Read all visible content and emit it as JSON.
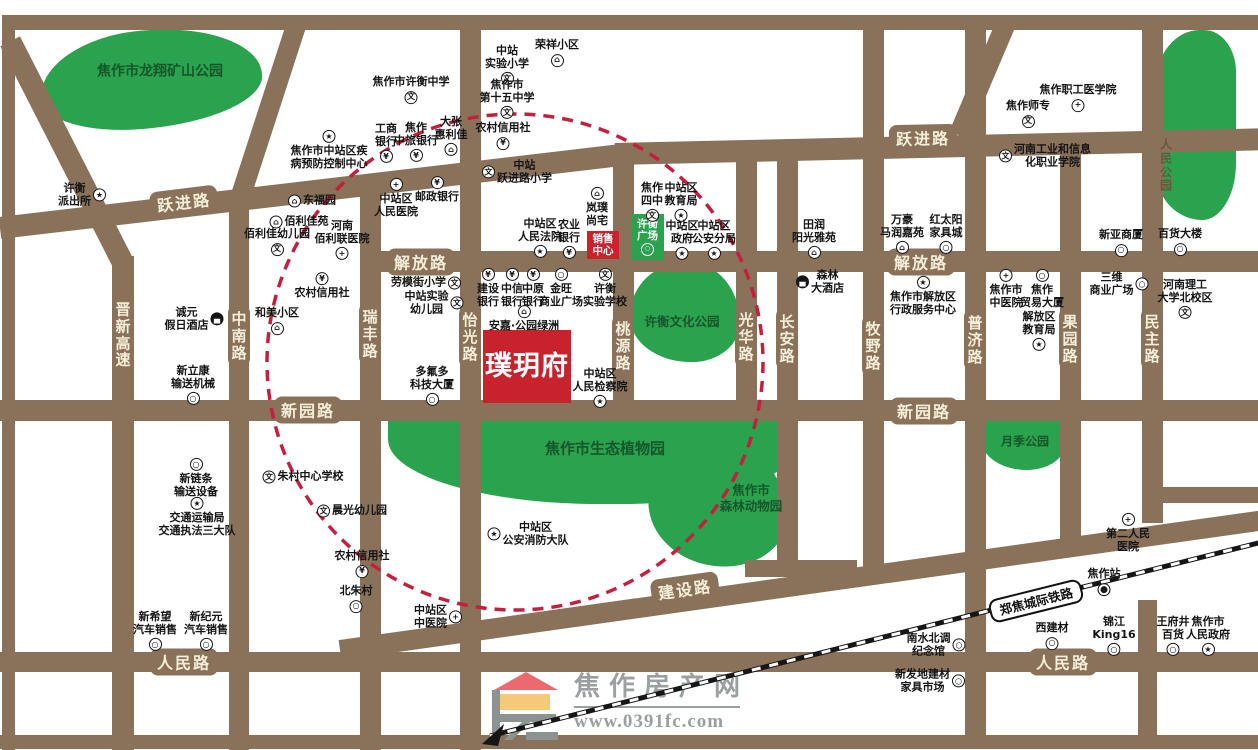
{
  "project": {
    "name": "璞玥府",
    "sales_label": "销售\n中心",
    "plaza_label": "许衡\n广场"
  },
  "logo": {
    "title": "焦作房产网",
    "url": "www.0391fc.com"
  },
  "colors": {
    "road": "#8a7159",
    "road_label_text": "#f6eed8",
    "park_green": "#2ba24d",
    "park_label": "#14572b",
    "accent_red": "#c8222d",
    "circle_red": "#c41f3e",
    "railway_black": "#161616",
    "logo_gray": "#9aa0a0",
    "logo_roof_red": "#ec6a6d",
    "logo_yellow": "#f6c87a"
  },
  "map": {
    "railway": {
      "label": "郑焦城际铁路",
      "station": "焦作站"
    },
    "road_labels_h": [
      {
        "t": "跃进路",
        "x": 184,
        "y": 202,
        "r": -7
      },
      {
        "t": "跃进路",
        "x": 923,
        "y": 138,
        "r": -1
      },
      {
        "t": "解放路",
        "x": 421,
        "y": 262,
        "r": 0
      },
      {
        "t": "解放路",
        "x": 921,
        "y": 262,
        "r": 0
      },
      {
        "t": "新园路",
        "x": 308,
        "y": 410,
        "r": 0
      },
      {
        "t": "新园路",
        "x": 924,
        "y": 411,
        "r": 0
      },
      {
        "t": "建设路",
        "x": 685,
        "y": 589,
        "r": -8
      },
      {
        "t": "人民路",
        "x": 184,
        "y": 662,
        "r": 0
      },
      {
        "t": "人民路",
        "x": 1063,
        "y": 662,
        "r": 0
      }
    ],
    "road_labels_v": [
      {
        "t": "晋新高速",
        "x": 123,
        "y": 335
      },
      {
        "t": "中南路",
        "x": 239,
        "y": 336
      },
      {
        "t": "瑞丰路",
        "x": 370,
        "y": 334
      },
      {
        "t": "怡光路",
        "x": 470,
        "y": 337
      },
      {
        "t": "桃源路",
        "x": 623,
        "y": 346
      },
      {
        "t": "光华路",
        "x": 746,
        "y": 337
      },
      {
        "t": "长安路",
        "x": 787,
        "y": 339
      },
      {
        "t": "牧野路",
        "x": 873,
        "y": 346
      },
      {
        "t": "普济路",
        "x": 975,
        "y": 340
      },
      {
        "t": "果园路",
        "x": 1070,
        "y": 339
      },
      {
        "t": "民主路",
        "x": 1152,
        "y": 339
      }
    ],
    "parks": [
      {
        "name": "焦作市龙翔矿山公园",
        "x": 40,
        "y": 30,
        "w": 222,
        "h": 98,
        "lx": 160,
        "ly": 72,
        "cls": "p1",
        "fs": 14,
        "style": "green",
        "vertical": false
      },
      {
        "name": "人民公园",
        "x": 1156,
        "y": 30,
        "w": 80,
        "h": 190,
        "lx": 1166,
        "ly": 166,
        "cls": "p2",
        "fs": 12,
        "style": "brown",
        "vertical": true
      },
      {
        "name": "许衡文化公园",
        "x": 630,
        "y": 262,
        "w": 110,
        "h": 100,
        "lx": 682,
        "ly": 322,
        "cls": "p3",
        "fs": 12.5,
        "style": "green",
        "vertical": false
      },
      {
        "name": "焦作市生态植物园",
        "x": 388,
        "y": 406,
        "w": 406,
        "h": 98,
        "lx": 605,
        "ly": 449,
        "cls": "p4",
        "fs": 15,
        "style": "green",
        "vertical": false
      },
      {
        "name": "焦作市\n森林动物园",
        "x": 648,
        "y": 448,
        "w": 140,
        "h": 118,
        "lx": 751,
        "ly": 498,
        "cls": "p5",
        "fs": 12.5,
        "style": "green",
        "vertical": false
      },
      {
        "name": "月季公园",
        "x": 981,
        "y": 416,
        "w": 84,
        "h": 54,
        "lx": 1025,
        "ly": 442,
        "cls": "p6",
        "fs": 12,
        "style": "green",
        "vertical": false
      }
    ],
    "pois": [
      {
        "n": "许衡\n派出所",
        "x": 82,
        "y": 195,
        "i": "gov",
        "p": "right"
      },
      {
        "n": "焦作市许衡中学",
        "x": 411,
        "y": 90,
        "i": "school",
        "p": "bottom"
      },
      {
        "n": "中站\n实验小学",
        "x": 507,
        "y": 65,
        "i": "school",
        "p": "bottom"
      },
      {
        "n": "荣祥小区",
        "x": 557,
        "y": 53,
        "i": "estate",
        "p": "bottom"
      },
      {
        "n": "焦作市\n第十五中学",
        "x": 507,
        "y": 99,
        "i": "school",
        "p": "bottom"
      },
      {
        "n": "农村信用社",
        "x": 503,
        "y": 136,
        "i": "bank",
        "p": "bottom"
      },
      {
        "n": "大张\n惠利佳",
        "x": 451,
        "y": 136,
        "i": "estate",
        "p": "bottom"
      },
      {
        "n": "工商\n银行",
        "x": 386,
        "y": 143,
        "i": "bank",
        "p": "bottom"
      },
      {
        "n": "焦作\n中旅银行",
        "x": 416,
        "y": 142,
        "i": "bank",
        "p": "bottom"
      },
      {
        "n": "焦作市中站区疾\n病预防控制中心",
        "x": 329,
        "y": 150,
        "i": "gov",
        "p": "top"
      },
      {
        "n": "东福园",
        "x": 312,
        "y": 201,
        "i": "estate",
        "p": "left"
      },
      {
        "n": "佰利佳苑",
        "x": 299,
        "y": 222,
        "i": "estate",
        "p": "left"
      },
      {
        "n": "佰利佳幼儿园",
        "x": 277,
        "y": 242,
        "i": "school",
        "p": "bottom"
      },
      {
        "n": "河南\n佰利联医院",
        "x": 342,
        "y": 240,
        "i": "hospital",
        "p": "bottom"
      },
      {
        "n": "中站区\n人民医院",
        "x": 396,
        "y": 198,
        "i": "hospital",
        "p": "top"
      },
      {
        "n": "邮政银行",
        "x": 437,
        "y": 190,
        "i": "bank",
        "p": "top"
      },
      {
        "n": "中站\n跃进路小学",
        "x": 517,
        "y": 172,
        "i": "school",
        "p": "left"
      },
      {
        "n": "岚璞\n尚宅",
        "x": 597,
        "y": 207,
        "i": "estate",
        "p": "top"
      },
      {
        "n": "中站区\n人民法院",
        "x": 540,
        "y": 238,
        "i": "gov",
        "p": "bottom"
      },
      {
        "n": "农业\n银行",
        "x": 569,
        "y": 239,
        "i": "bank",
        "p": "bottom"
      },
      {
        "n": "焦作\n四中",
        "x": 652,
        "y": 202,
        "i": "school",
        "p": "bottom"
      },
      {
        "n": "中站区\n教育局",
        "x": 681,
        "y": 202,
        "i": "gov",
        "p": "bottom"
      },
      {
        "n": "中站区\n政府",
        "x": 682,
        "y": 240,
        "i": "gov",
        "p": "bottom"
      },
      {
        "n": "中站区\n公安分局",
        "x": 714,
        "y": 240,
        "i": "gov",
        "p": "bottom"
      },
      {
        "n": "田润\n阳光雅苑",
        "x": 814,
        "y": 239,
        "i": "estate",
        "p": "bottom"
      },
      {
        "n": "万豪\n马润嘉苑",
        "x": 902,
        "y": 234,
        "i": "estate",
        "p": "bottom"
      },
      {
        "n": "红太阳\n家具城",
        "x": 946,
        "y": 234,
        "i": "biz",
        "p": "bottom"
      },
      {
        "n": "焦作职工医学院",
        "x": 1078,
        "y": 98,
        "i": "hospital",
        "p": "bottom"
      },
      {
        "n": "焦作师专",
        "x": 1028,
        "y": 114,
        "i": "school",
        "p": "bottom"
      },
      {
        "n": "河南工业和信息\n化职业学院",
        "x": 1045,
        "y": 156,
        "i": "school",
        "p": "left"
      },
      {
        "n": "新亚商厦",
        "x": 1121,
        "y": 243,
        "i": "biz",
        "p": "bottom"
      },
      {
        "n": "百货大楼",
        "x": 1180,
        "y": 242,
        "i": "biz",
        "p": "bottom"
      },
      {
        "n": "森林\n大酒店",
        "x": 820,
        "y": 282,
        "i": "hotel",
        "p": "left"
      },
      {
        "n": "焦作市解放区\n行政服务中心",
        "x": 923,
        "y": 296,
        "i": "gov",
        "p": "top"
      },
      {
        "n": "焦作市\n中医院",
        "x": 1006,
        "y": 289,
        "i": "hospital",
        "p": "top"
      },
      {
        "n": "焦作\n贸易大厦",
        "x": 1042,
        "y": 289,
        "i": "biz",
        "p": "top"
      },
      {
        "n": "解放区\n教育局",
        "x": 1039,
        "y": 331,
        "i": "gov",
        "p": "bottom"
      },
      {
        "n": "三维\n商业广场",
        "x": 1119,
        "y": 284,
        "i": "biz",
        "p": "right"
      },
      {
        "n": "河南理工\n大学北校区",
        "x": 1185,
        "y": 299,
        "i": "school",
        "p": "bottom"
      },
      {
        "n": "劳模街小学",
        "x": 426,
        "y": 283,
        "i": "school",
        "p": "right"
      },
      {
        "n": "中站实验\n幼儿园",
        "x": 434,
        "y": 303,
        "i": "school",
        "p": "right"
      },
      {
        "n": "建设\n银行",
        "x": 488,
        "y": 288,
        "i": "bank",
        "p": "top"
      },
      {
        "n": "中信\n银行",
        "x": 512,
        "y": 288,
        "i": "bank",
        "p": "top"
      },
      {
        "n": "中原\n银行",
        "x": 533,
        "y": 288,
        "i": "bank",
        "p": "top"
      },
      {
        "n": "金旺\n商业广场",
        "x": 561,
        "y": 288,
        "i": "biz",
        "p": "top"
      },
      {
        "n": "许衡\n实验学校",
        "x": 605,
        "y": 288,
        "i": "school",
        "p": "top"
      },
      {
        "n": "安嘉·公园绿洲",
        "x": 524,
        "y": 319,
        "i": "estate",
        "p": "top"
      },
      {
        "n": "多氟多\n科技大厦",
        "x": 432,
        "y": 386,
        "i": "biz",
        "p": "bottom"
      },
      {
        "n": "中站区\n人民检察院",
        "x": 600,
        "y": 388,
        "i": "gov",
        "p": "bottom"
      },
      {
        "n": "和美小区",
        "x": 277,
        "y": 321,
        "i": "estate",
        "p": "bottom"
      },
      {
        "n": "农村信用社",
        "x": 322,
        "y": 286,
        "i": "bank",
        "p": "top"
      },
      {
        "n": "诚元\n假日酒店",
        "x": 194,
        "y": 319,
        "i": "hotel",
        "p": "right"
      },
      {
        "n": "新立康\n输送机械",
        "x": 193,
        "y": 385,
        "i": "biz",
        "p": "bottom"
      },
      {
        "n": "朱村中心学校",
        "x": 303,
        "y": 477,
        "i": "school",
        "p": "left"
      },
      {
        "n": "晨光幼儿园",
        "x": 352,
        "y": 511,
        "i": "school",
        "p": "left"
      },
      {
        "n": "农村信用社",
        "x": 362,
        "y": 564,
        "i": "bank",
        "p": "bottom"
      },
      {
        "n": "北朱村",
        "x": 356,
        "y": 599,
        "i": "biz",
        "p": "bottom"
      },
      {
        "n": "新链条\n输送设备",
        "x": 196,
        "y": 478,
        "i": "biz",
        "p": "top"
      },
      {
        "n": "交通运输局\n交通执法三大队",
        "x": 197,
        "y": 517,
        "i": "gov",
        "p": "top"
      },
      {
        "n": "新希望\n汽车销售",
        "x": 155,
        "y": 631,
        "i": "biz",
        "p": "bottom"
      },
      {
        "n": "新纪元\n汽车销售",
        "x": 206,
        "y": 631,
        "i": "biz",
        "p": "bottom"
      },
      {
        "n": "中站区\n中医院",
        "x": 438,
        "y": 617,
        "i": "hospital",
        "p": "right"
      },
      {
        "n": "中站区\n公安消防大队",
        "x": 528,
        "y": 534,
        "i": "gov",
        "p": "left"
      },
      {
        "n": "第二人民\n医院",
        "x": 1128,
        "y": 533,
        "i": "hospital",
        "p": "top"
      },
      {
        "n": "焦作站",
        "x": 1104,
        "y": 582,
        "i": "station",
        "p": "bottom"
      },
      {
        "n": "南水北调\n纪念馆",
        "x": 936,
        "y": 645,
        "i": "biz",
        "p": "right"
      },
      {
        "n": "西建材",
        "x": 1052,
        "y": 636,
        "i": "biz",
        "p": "bottom"
      },
      {
        "n": "锦江\nKing16",
        "x": 1114,
        "y": 636,
        "i": "biz",
        "p": "bottom"
      },
      {
        "n": "王府井\n百货",
        "x": 1173,
        "y": 636,
        "i": "biz",
        "p": "bottom"
      },
      {
        "n": "焦作市\n人民政府",
        "x": 1208,
        "y": 636,
        "i": "gov",
        "p": "bottom"
      },
      {
        "n": "新发地建材\n家具市场",
        "x": 930,
        "y": 681,
        "i": "biz",
        "p": "right"
      }
    ]
  }
}
